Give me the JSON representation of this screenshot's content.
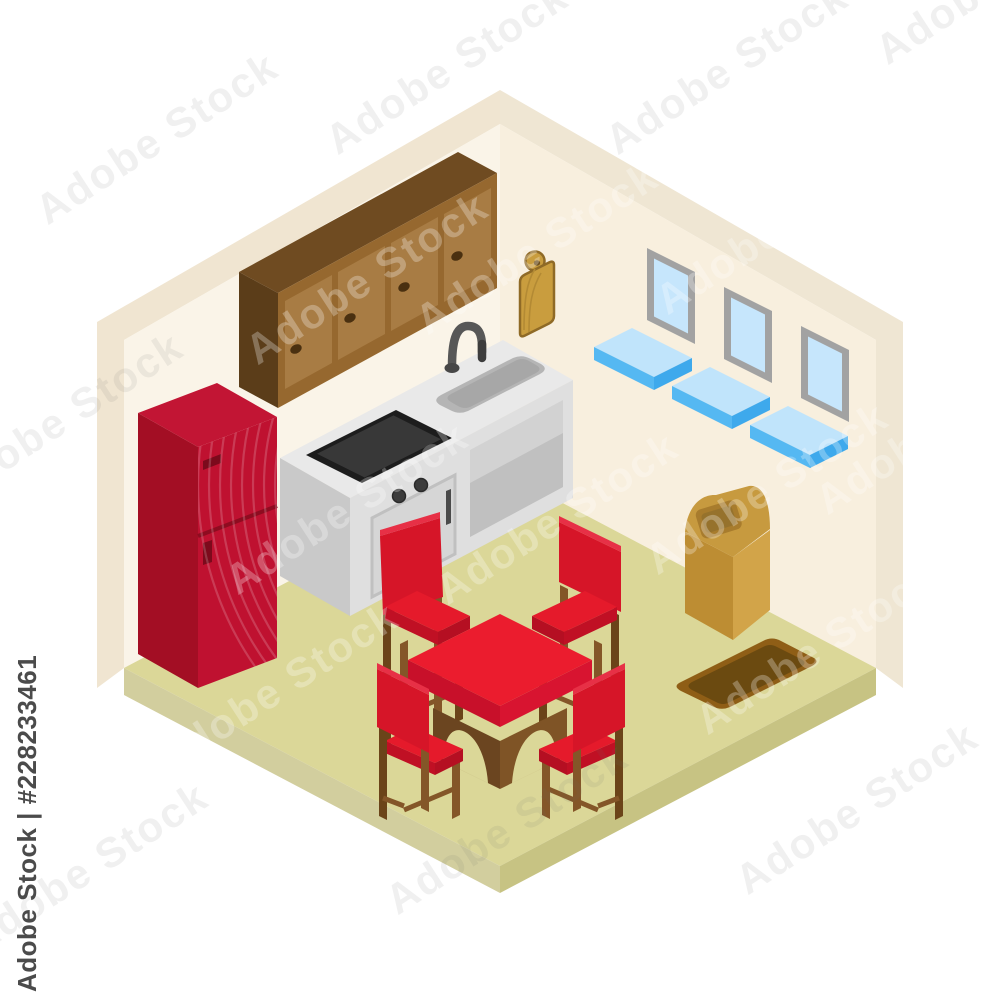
{
  "watermark": {
    "label": "Adobe Stock | #228233461",
    "tile_text": "Adobe Stock"
  },
  "scene": {
    "title": "Isometric kitchen room illustration",
    "description": "Cutaway isometric kitchen interior with cream walls and olive floor on white background",
    "room": {
      "wall_color": "#f8f0e2",
      "wall_edge_color": "#f0e5d1",
      "floor_color": "#dbd798",
      "floor_side_color": "#cdc892"
    },
    "objects": [
      {
        "name": "refrigerator",
        "color": "#bf1130",
        "doors": 2
      },
      {
        "name": "wall-cabinets",
        "color": "#a87c44",
        "doors": 4
      },
      {
        "name": "kitchen-counter",
        "color": "#e3e3e3",
        "features": [
          "sink",
          "faucet",
          "cooktop",
          "oven-door",
          "open-shelf"
        ]
      },
      {
        "name": "cutting-board",
        "color": "#c99d3e"
      },
      {
        "name": "windows",
        "count": 3,
        "glass_color": "#c6e6fc",
        "frame_color": "#a2a2a2"
      },
      {
        "name": "window-sills",
        "count": 3,
        "color": "#55b8f2"
      },
      {
        "name": "trash-bin",
        "color": "#d2a449"
      },
      {
        "name": "rug",
        "color": "#6b4a10",
        "border_color": "#8f5e16"
      },
      {
        "name": "dining-table",
        "top_color": "#eb1c2e",
        "base_color": "#7f5426"
      },
      {
        "name": "chairs",
        "count": 4,
        "seat_color": "#e51a2b",
        "wood_color": "#845628"
      }
    ]
  }
}
